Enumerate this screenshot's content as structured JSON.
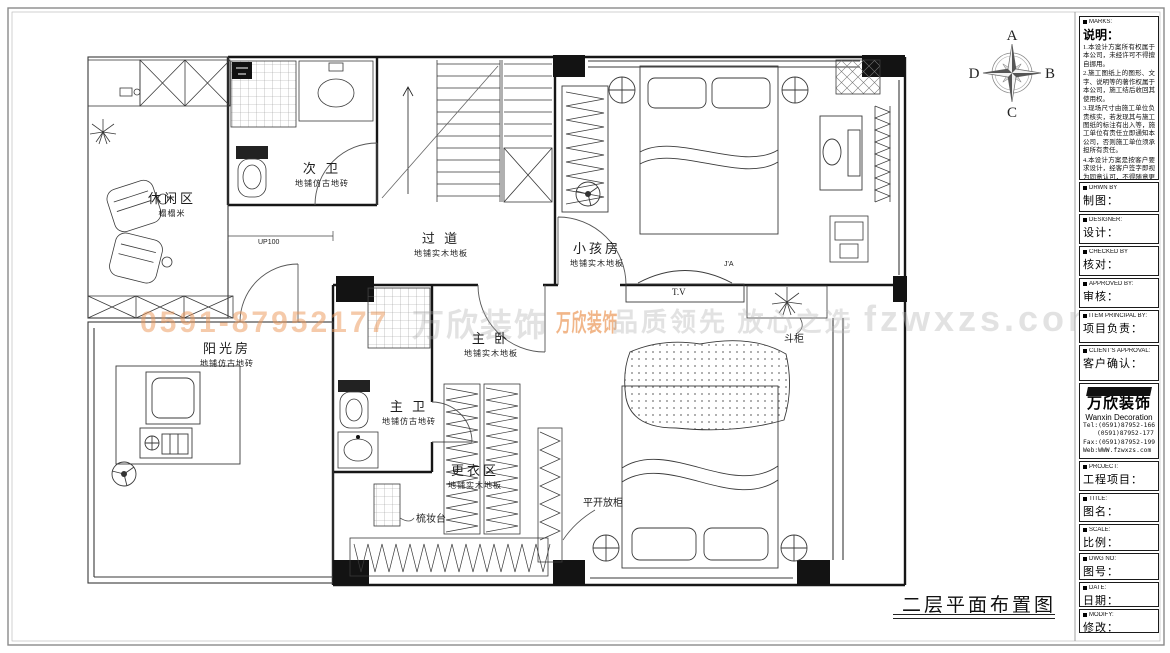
{
  "plan": {
    "rooms": [
      {
        "name": "休闲区",
        "sub": "榻榻米"
      },
      {
        "name": "次 卫",
        "sub": "地铺仿古地砖"
      },
      {
        "name": "过 道",
        "sub": "地铺实木地板"
      },
      {
        "name": "小孩房",
        "sub": "地铺实木地板"
      },
      {
        "name": "阳光房",
        "sub": "地铺仿古地砖"
      },
      {
        "name": "主 卧",
        "sub": "地铺实木地板"
      },
      {
        "name": "主 卫",
        "sub": "地铺仿古地砖"
      },
      {
        "name": "更衣区",
        "sub": "地铺实木地板"
      }
    ],
    "labels": {
      "vanity": "梳妆台",
      "cabinet": "平开放柜",
      "tv": "T.V",
      "chest": "斗柜",
      "up": "UP100",
      "door_tag": "J'A"
    },
    "title": "二层平面布置图"
  },
  "compass": {
    "n": "A",
    "e": "B",
    "s": "C",
    "w": "D"
  },
  "watermark": {
    "phone": "0591-87952177",
    "brand": "万欣装饰",
    "logo": "万欣装饰",
    "slogan": "品质领先 放心之选",
    "site": "fzwxzs.com"
  },
  "sidebar": {
    "notes": {
      "tag": "MARKS:",
      "label": "说明：",
      "items": [
        "1.本设计方案所有权属于本公司，未经许可不得擅自挪用。",
        "2.施工图纸上的图形、文字、说明等的著作权属于本公司，施工结后收回其使用权。",
        "3.现场尺寸由施工单位负责核实，若发现其与施工图纸的标注有出入等，施工单位有责任立即通知本公司，否则施工单位须承担所有责任。",
        "4.本设计方案是按客户要求设计，经客户签字即视为同意认可，不得随意更改。"
      ]
    },
    "fields": [
      {
        "tag": "DRWN BY",
        "label": "制图："
      },
      {
        "tag": "DESIGNER:",
        "label": "设计："
      },
      {
        "tag": "CHECKED BY",
        "label": "核对："
      },
      {
        "tag": "APPROVED BY:",
        "label": "审核："
      },
      {
        "tag": "ITEM PRINCIPAL BY:",
        "label": "项目负责："
      },
      {
        "tag": "CLIENT'S APPROVAL:",
        "label": "客户确认："
      }
    ],
    "company": {
      "logo_text": "万欣装饰",
      "name_en": "Wanxin Decoration",
      "tel1": "Tel:(0591)87952-166",
      "tel2": "(0591)87952-177",
      "fax": "Fax:(0591)87952-199",
      "web": "Web:WWW.fzwxzs.com"
    },
    "fields2": [
      {
        "tag": "PROJECT:",
        "label": "工程项目："
      },
      {
        "tag": "TITLE:",
        "label": "图名："
      },
      {
        "tag": "SCALE:",
        "label": "比例："
      },
      {
        "tag": "DWG NO:",
        "label": "图号："
      },
      {
        "tag": "DATE:",
        "label": "日期："
      },
      {
        "tag": "MODIFY:",
        "label": "修改："
      }
    ]
  }
}
